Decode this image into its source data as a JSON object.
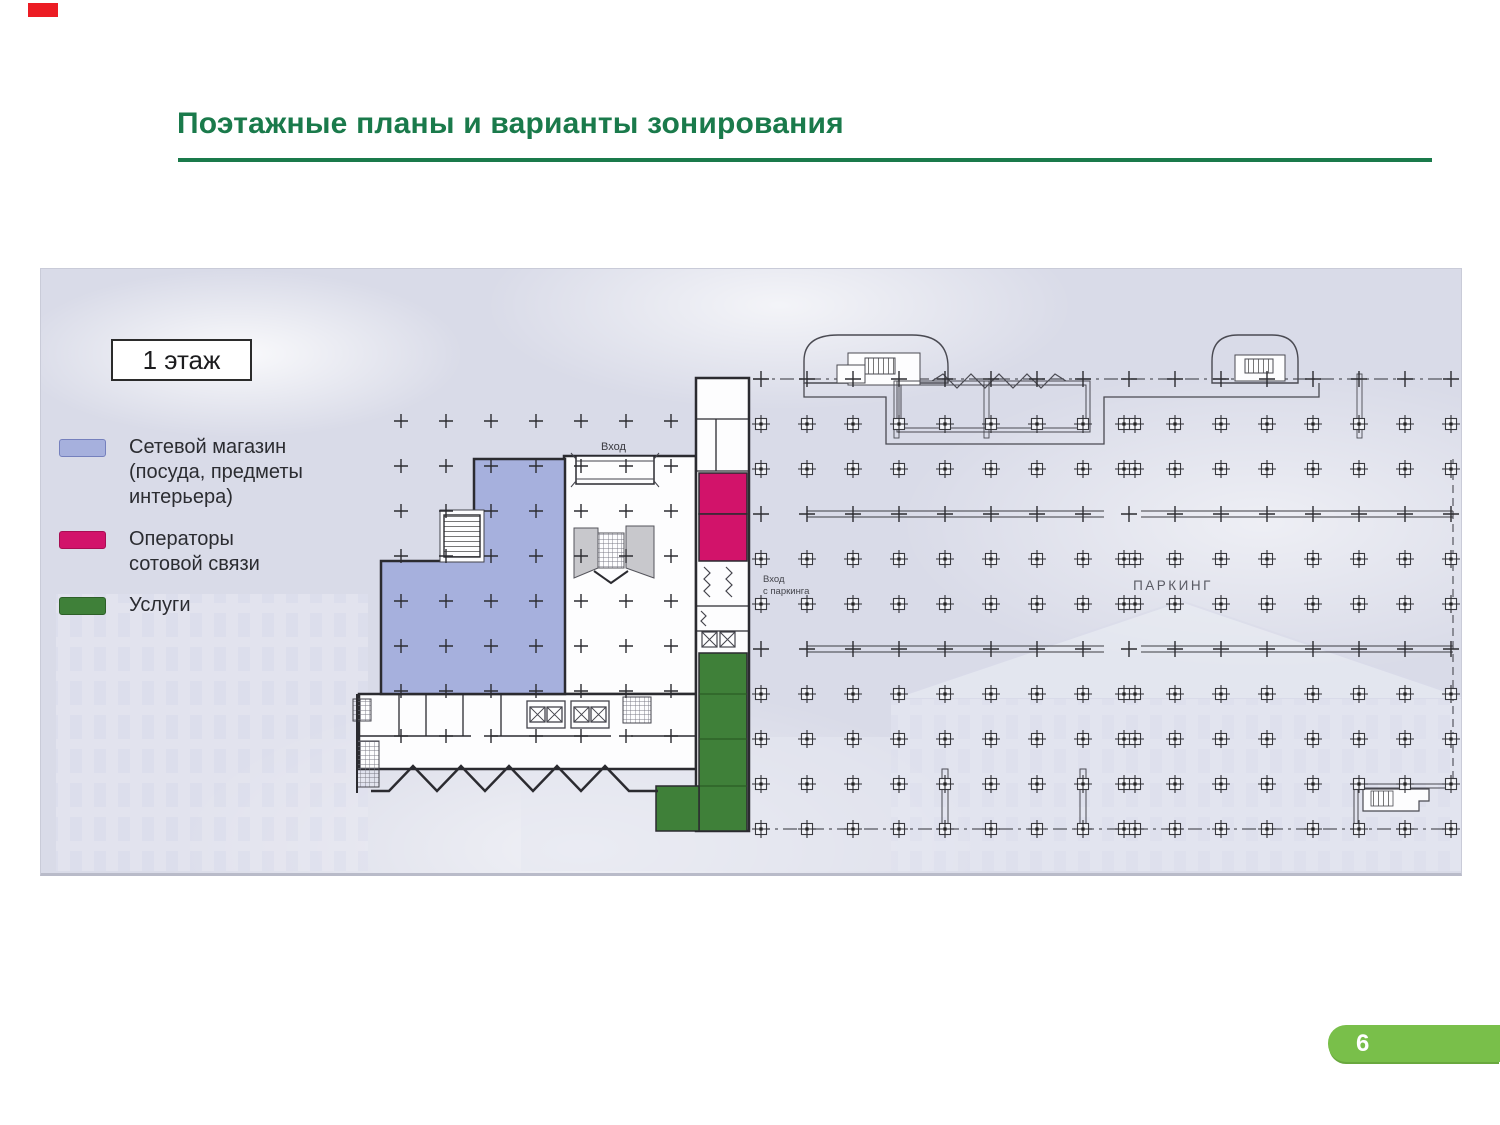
{
  "slide": {
    "title": "Поэтажные планы и варианты зонирования",
    "page_number": "6"
  },
  "colors": {
    "title_green": "#1a7a4b",
    "badge_green": "#79bf4a",
    "zone_blue": "#a6b0dd",
    "zone_pink": "#d2136a",
    "zone_green": "#3f8039",
    "plan_background": "#d9dbe8"
  },
  "plan": {
    "floor_label": "1 этаж",
    "legend": [
      {
        "zone": "blue",
        "lines": [
          "Сетевой магазин",
          "(посуда, предметы",
          "интерьера)"
        ]
      },
      {
        "zone": "pink",
        "lines": [
          "Операторы",
          "сотовой связи"
        ]
      },
      {
        "zone": "green",
        "lines": [
          "Услуги"
        ]
      }
    ],
    "labels": {
      "entrance": "Вход",
      "parking_entrance_line1": "Вход",
      "parking_entrance_line2": "с паркинга",
      "parking": "ПАРКИНГ"
    },
    "parking_grid": {
      "x_start": 720,
      "y_start": 110,
      "x_step": 46,
      "y_step": 45,
      "cols": 16,
      "rows": 11,
      "plain_cross_rows": [
        0,
        3,
        6
      ],
      "double_col": 8
    },
    "building_grid": {
      "x_start": 360,
      "y_start": 152,
      "x_step": 45,
      "y_step": 45,
      "cols": 7,
      "rows": 8
    }
  }
}
